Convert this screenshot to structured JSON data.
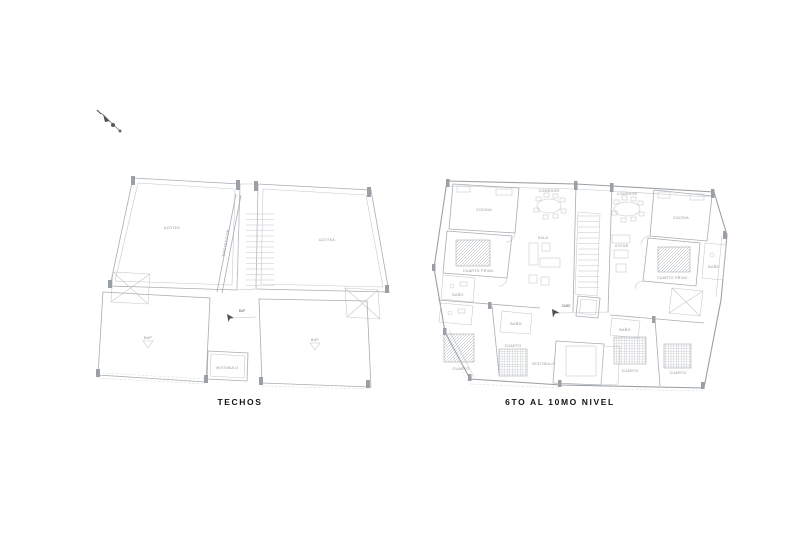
{
  "canvas": {
    "width": 800,
    "height": 539,
    "background": "#ffffff"
  },
  "colors": {
    "wall": "#9aa0a6",
    "light_line": "#c2c6cb",
    "label_text": "#8d9196",
    "title_text": "#141414",
    "annotation_dark": "#4a4e53"
  },
  "plans": {
    "left": {
      "title": "TECHOS",
      "labels": {
        "roof_left": "AZOTEA",
        "roof_right": "AZOTEA",
        "ramp": "PROYECCION",
        "drain_left": "BAP",
        "drain_right": "BAP",
        "bulkhead": "VESTIBULO",
        "note": "BAP"
      }
    },
    "right": {
      "title": "6TO AL 10MO NIVEL",
      "labels": {
        "kitchen_left": "COCINA",
        "dining_left": "COMEDOR",
        "living_left": "SALA",
        "master_left": "CUARTO PRINC.",
        "bath_left_1": "BAÑO",
        "bedroom_left_1": "CUARTO",
        "bedroom_left_2": "CUARTO",
        "bath_left_2": "BAÑO",
        "hall": "VESTIBULO",
        "dining_right": "COMEDOR",
        "kitchen_right": "COCINA",
        "living_right": "ESTAR",
        "master_right": "CUARTO PRINC.",
        "bath_right_1": "BAÑO",
        "bedroom_right_1": "CUARTO",
        "bedroom_right_2": "CUARTO",
        "bath_right_2": "BAÑO",
        "note": "SUBE"
      }
    }
  }
}
